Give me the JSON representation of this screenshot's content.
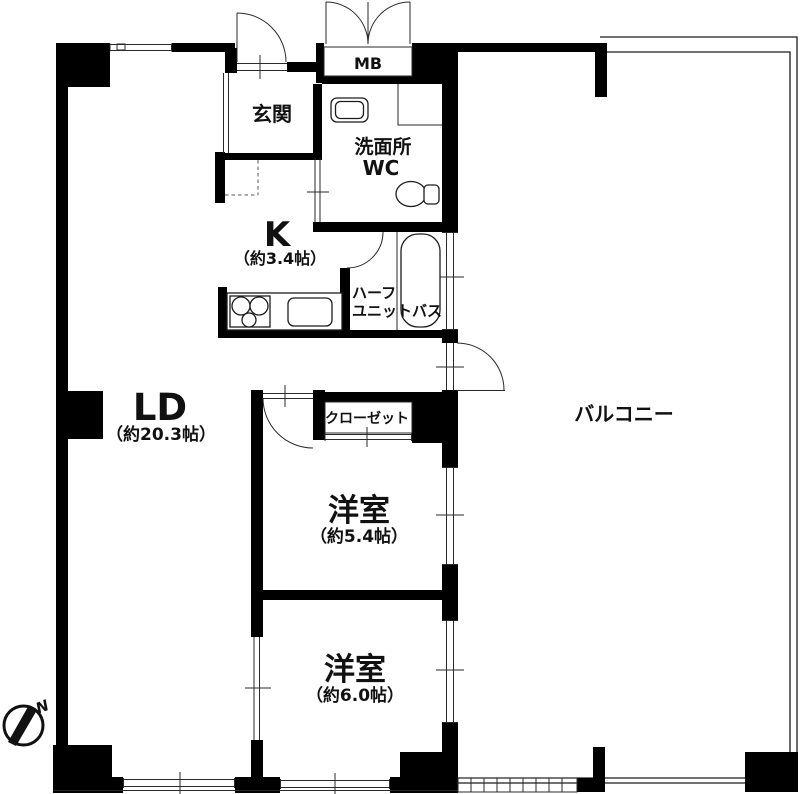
{
  "rooms": {
    "living_dining": {
      "label": "LD",
      "size": "（約20.3帖）"
    },
    "kitchen": {
      "label": "K",
      "size": "（約3.4帖）"
    },
    "bedroom1": {
      "label": "洋室",
      "size": "（約5.4帖）"
    },
    "bedroom2": {
      "label": "洋室",
      "size": "（約6.0帖）"
    },
    "entrance": {
      "label": "玄関"
    },
    "washroom": {
      "label_line1": "洗面所",
      "label_line2": "WC"
    },
    "bath": {
      "label_line1": "ハーフ",
      "label_line2": "ユニットバス"
    },
    "closet": {
      "label": "クローゼット"
    },
    "balcony": {
      "label": "バルコニー"
    },
    "meter_box": {
      "label": "MB"
    }
  },
  "compass": {
    "north_label": "N"
  },
  "colors": {
    "wall": "#000000",
    "line": "#1c1c1c",
    "background": "#ffffff"
  }
}
